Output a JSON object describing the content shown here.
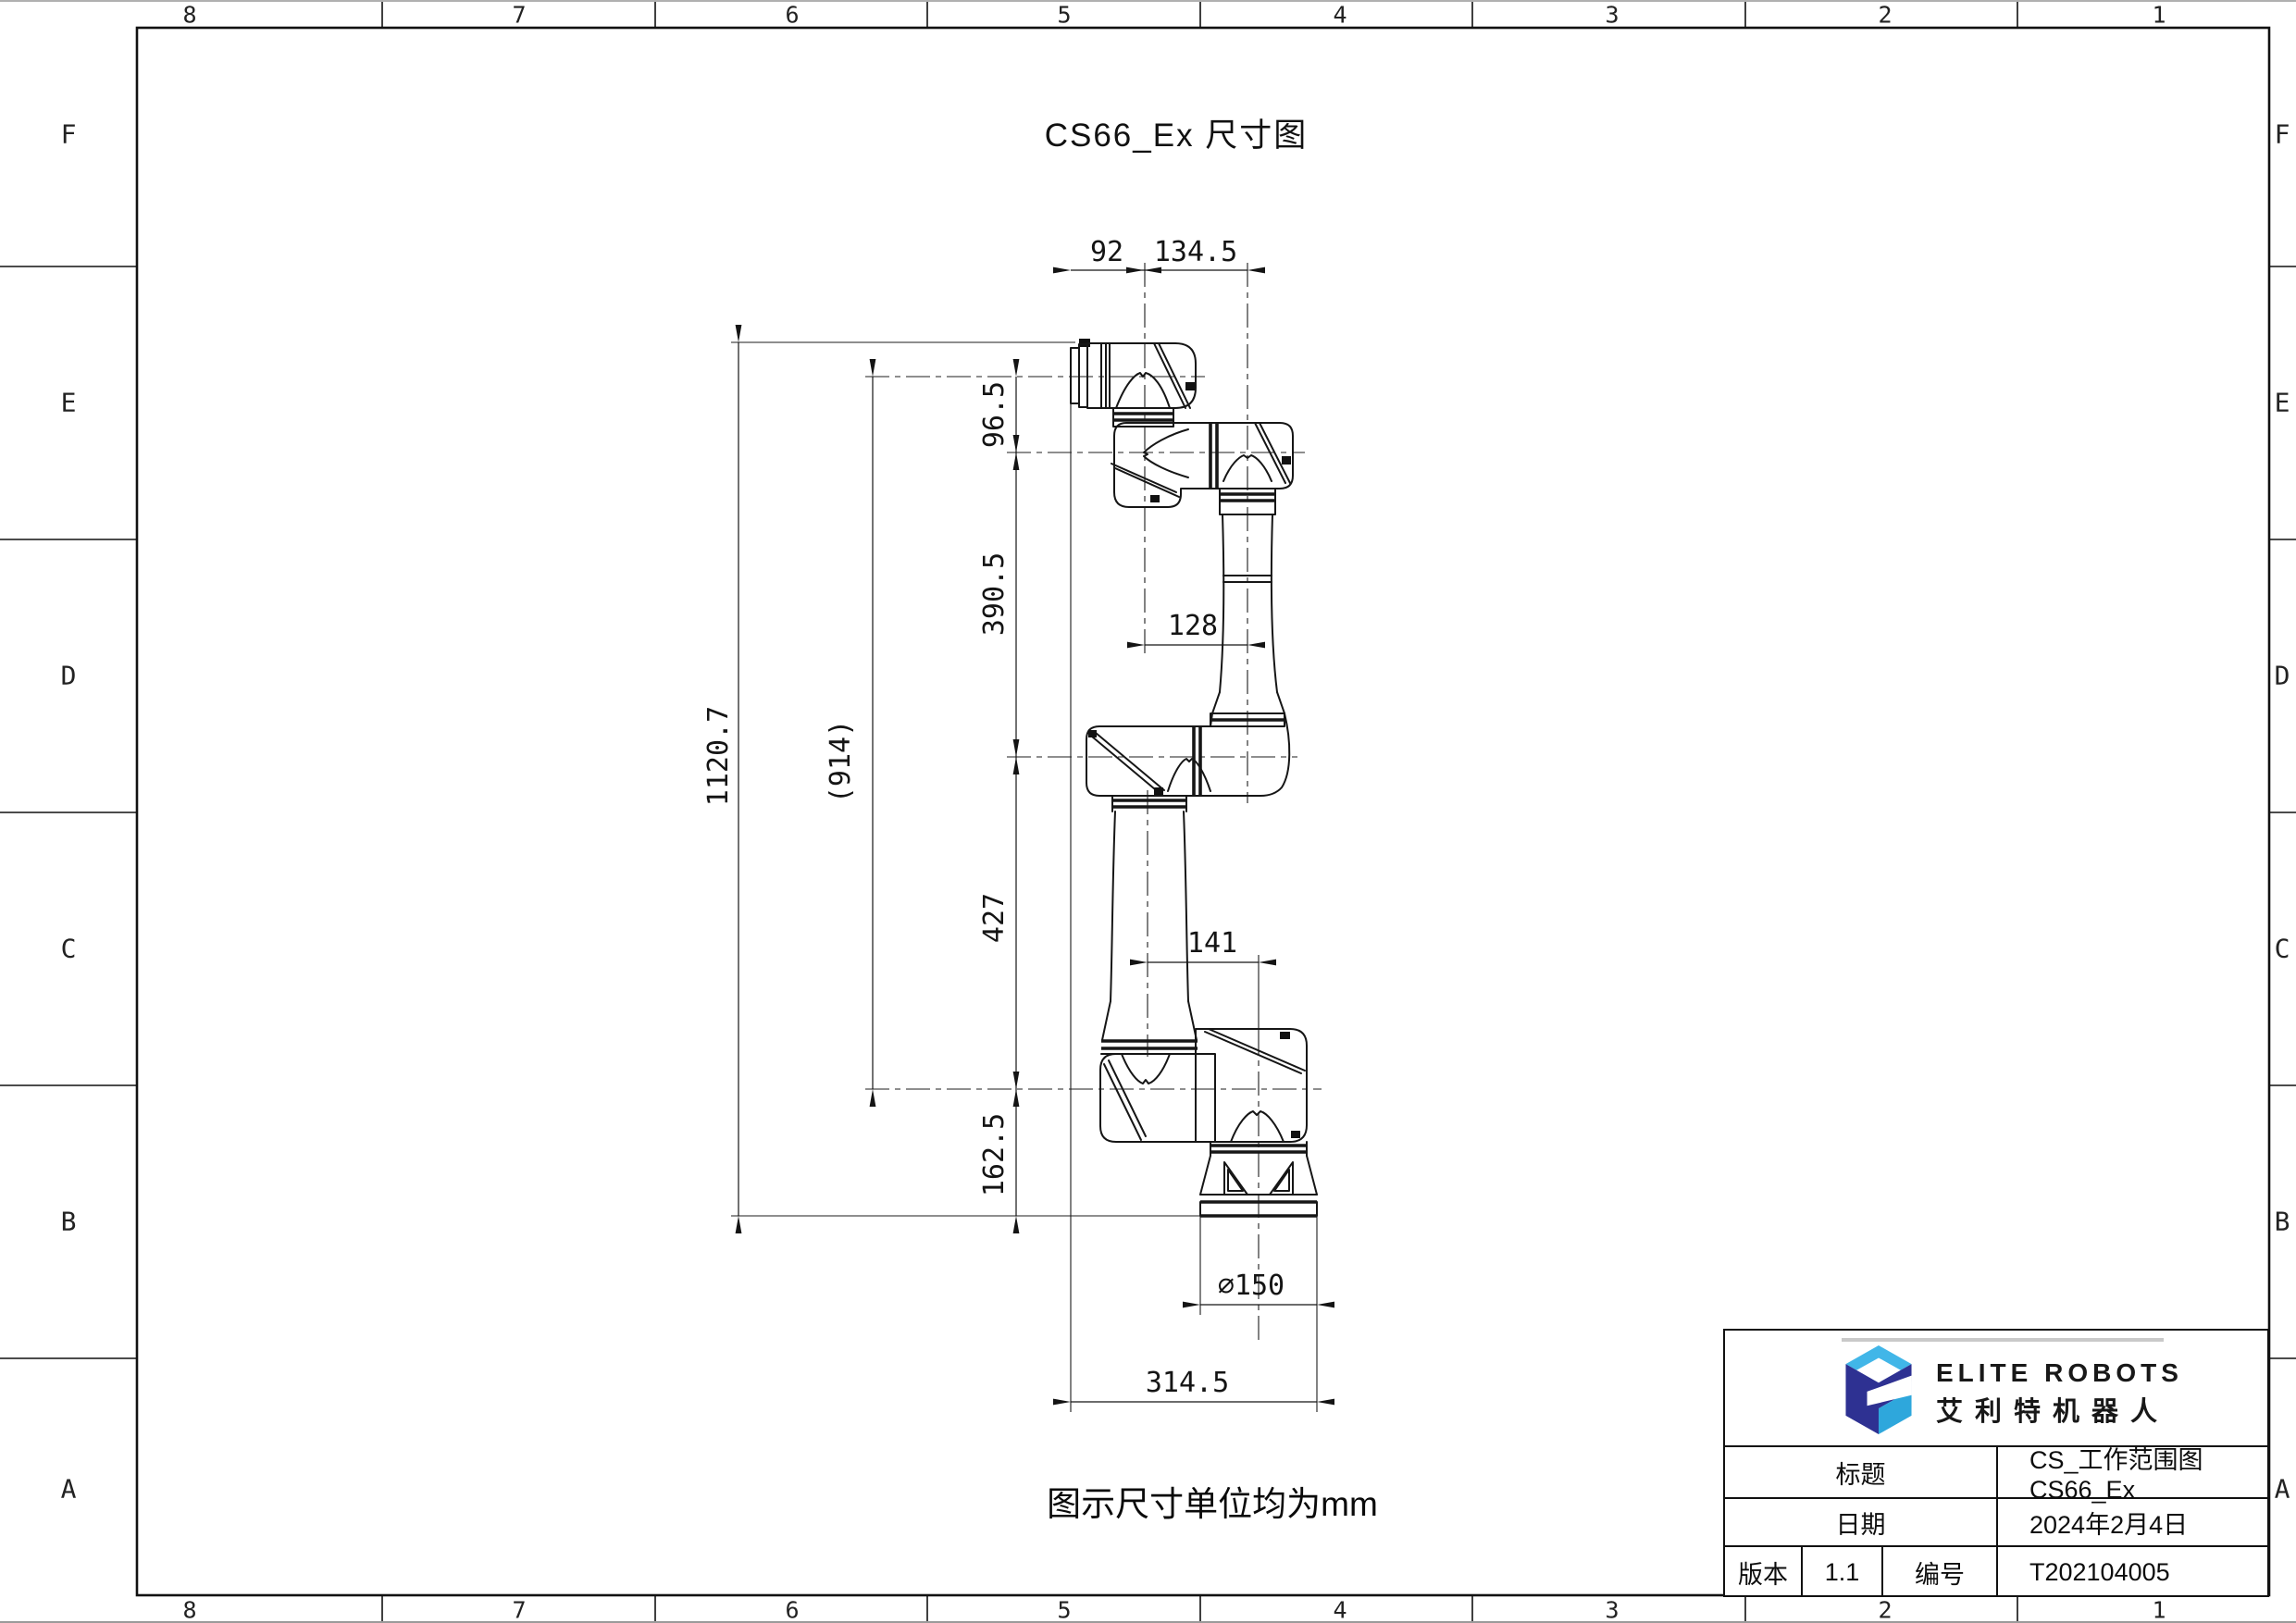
{
  "sheet": {
    "title": "CS66_Ex 尺寸图",
    "note": "图示尺寸单位均为mm",
    "zones": {
      "columns": [
        "8",
        "7",
        "6",
        "5",
        "4",
        "3",
        "2",
        "1"
      ],
      "rows": [
        "F",
        "E",
        "D",
        "C",
        "B",
        "A"
      ]
    }
  },
  "dimensions": {
    "top_width_1": "92",
    "top_width_2": "134.5",
    "wrist_offset": "96.5",
    "forearm_length": "390.5",
    "overall_height": "1120.7",
    "working_reach": "(914)",
    "upper_arm_length": "427",
    "base_height": "162.5",
    "elbow_offset": "128",
    "shoulder_offset": "141",
    "base_diameter": "⌀150",
    "footprint_width": "314.5"
  },
  "title_block": {
    "brand": {
      "name_en": "ELITE ROBOTS",
      "name_cn": "艾利特机器人",
      "logo_dark": "#2e3192",
      "logo_light": "#41b6e8",
      "logo_mid": "#2ea7dc"
    },
    "title_label": "标题",
    "title_value": "CS_工作范围图 CS66_Ex",
    "date_label": "日期",
    "date_value": "2024年2月4日",
    "version_label": "版本",
    "version_value": "1.1",
    "number_label": "编号",
    "number_value": "T202104005"
  }
}
